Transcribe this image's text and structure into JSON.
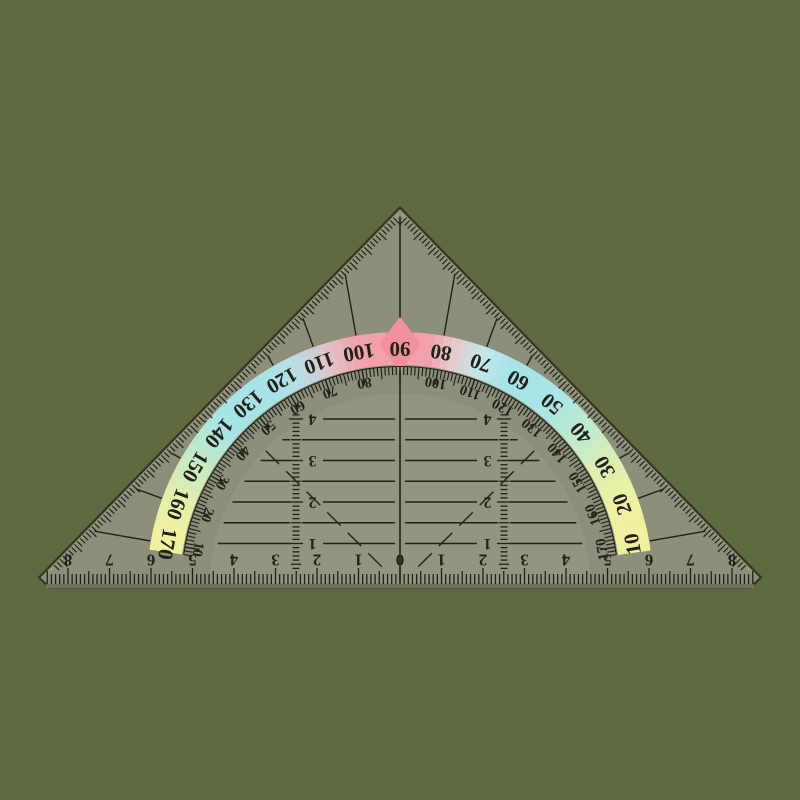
{
  "object_title": "geodreieck-protractor-set-square",
  "colors": {
    "background": "#5E6B41",
    "body": "#8C8F79",
    "body_inner": "#92957F",
    "edge_dark": "#34361F",
    "bevel_light": "#9B9D87",
    "bevel_dark": "#6F7258",
    "print": "#21211B",
    "diamond": "#F2909E"
  },
  "band_color_stops": [
    [
      8,
      "#F0F09E"
    ],
    [
      20,
      "#EFF0A0"
    ],
    [
      30,
      "#DCEFAE"
    ],
    [
      40,
      "#BFEAD0"
    ],
    [
      50,
      "#A9E6E4"
    ],
    [
      62,
      "#A3E3E8"
    ],
    [
      70,
      "#C2E7EA"
    ],
    [
      77,
      "#E4CCCE"
    ],
    [
      83,
      "#F0A2AC"
    ],
    [
      90,
      "#F49EA8"
    ],
    [
      100,
      "#F1A1AB"
    ],
    [
      108,
      "#DFC5C9"
    ],
    [
      116,
      "#B8DEE4"
    ],
    [
      124,
      "#A8E2E6"
    ],
    [
      138,
      "#A5E5E4"
    ],
    [
      148,
      "#C2E9C6"
    ],
    [
      158,
      "#E2EFAE"
    ],
    [
      166,
      "#EFF0A0"
    ],
    [
      172,
      "#F0F09E"
    ]
  ],
  "outer_degree_scale": {
    "start": 10,
    "end": 170,
    "step": 10,
    "values": [
      10,
      20,
      30,
      40,
      50,
      60,
      70,
      80,
      90,
      100,
      110,
      120,
      130,
      140,
      150,
      160,
      170
    ]
  },
  "inner_degree_scale": {
    "start": 10,
    "end": 170,
    "step": 10,
    "skip": 90,
    "values": [
      170,
      160,
      150,
      140,
      130,
      120,
      110,
      100,
      80,
      70,
      60,
      50,
      40,
      30,
      20,
      10
    ]
  },
  "ruler": {
    "center_label": "0",
    "left_labels": [
      "1",
      "2",
      "3",
      "4",
      "5",
      "6",
      "7",
      "8"
    ],
    "right_labels": [
      "1",
      "2",
      "3",
      "4",
      "5",
      "6",
      "7",
      "8"
    ]
  },
  "parallel_line_labels": [
    "1",
    "2",
    "3",
    "4"
  ]
}
